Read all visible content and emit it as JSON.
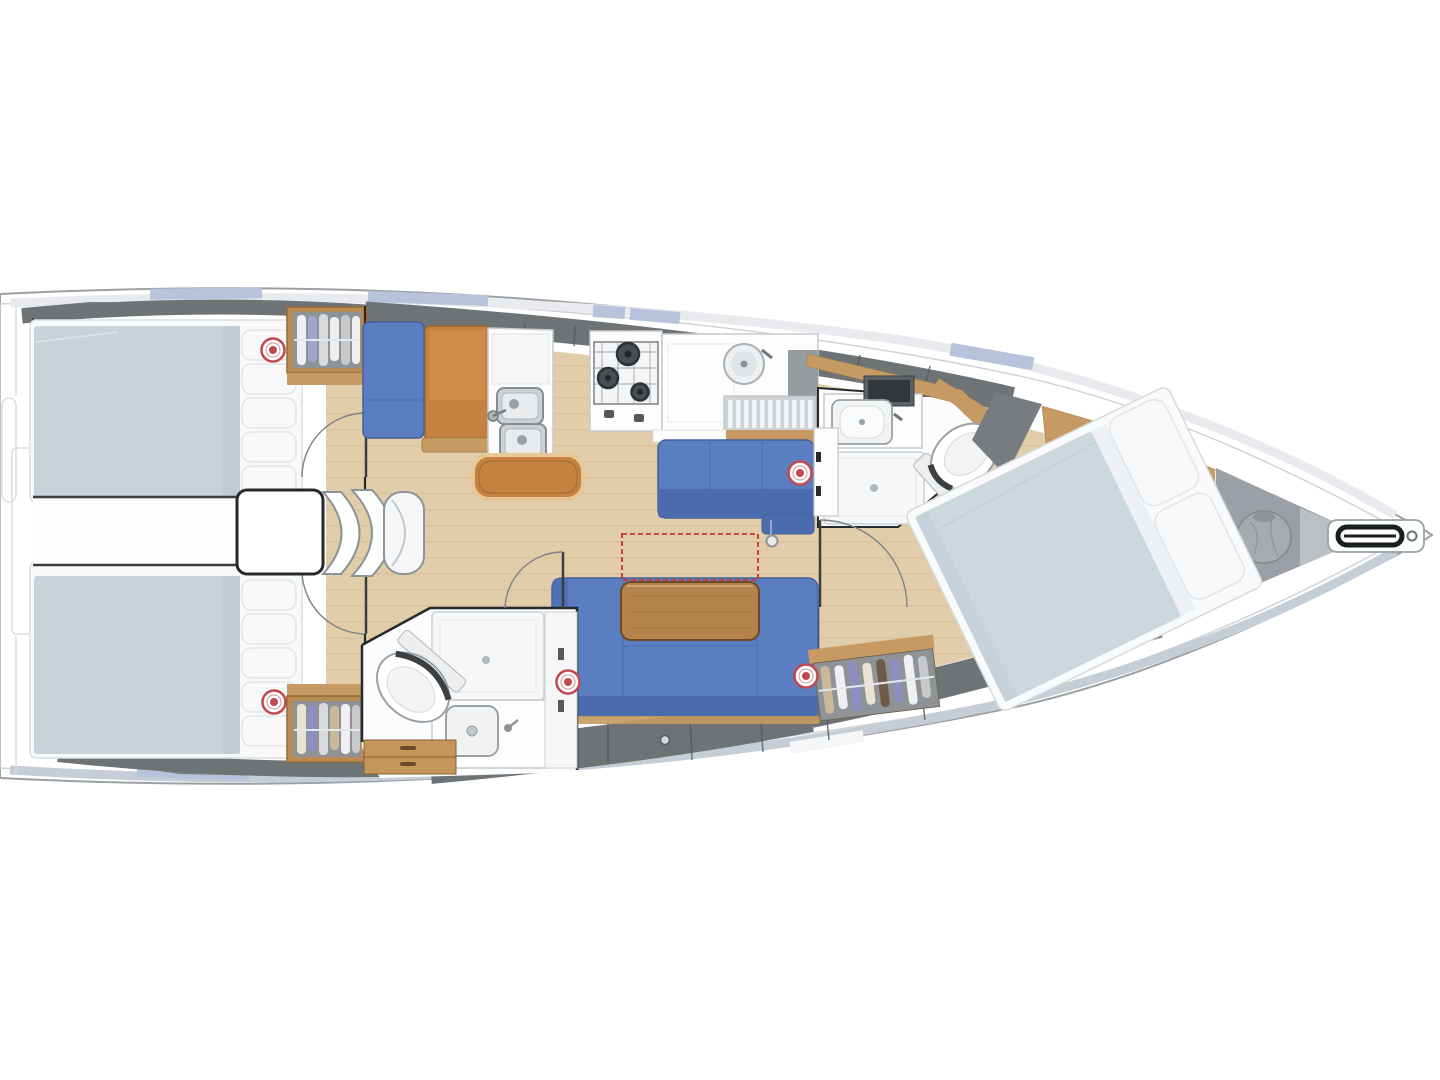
{
  "diagram": {
    "type": "sailboat-interior-floor-plan",
    "view": "top-down",
    "orientation": "bow-pointing-right",
    "rooms": [
      "aft-cabin-port",
      "aft-cabin-starboard",
      "companionway",
      "nav-station",
      "galley",
      "aft-head",
      "salon",
      "forward-head",
      "forward-cabin",
      "anchor-locker"
    ],
    "equipment": [
      "double-berth-aft-port",
      "double-berth-aft-starboard",
      "engine-box",
      "companionway-steps",
      "hanging-locker-aft-port",
      "hanging-locker-aft-starboard",
      "hanging-locker-forward",
      "nav-seat",
      "chart-table",
      "double-sink",
      "stove",
      "galley-counter",
      "round-sink",
      "dish-rack",
      "galley-bench",
      "port-settee",
      "dinette-settee",
      "salon-table",
      "table-extension-outline",
      "mast-foot",
      "toilet-aft",
      "shower-aft",
      "washbasin-aft",
      "toilet-forward",
      "shower-forward",
      "washbasin-forward",
      "forward-double-berth",
      "sail-bag",
      "bowsprit",
      "anchor-roller"
    ],
    "deck_hatch_count": 5
  },
  "colors": {
    "bg": "#ffffff",
    "hull_stroke": "#9aa0a4",
    "liner": "#cdd1d5",
    "deck_band": "#e8eaed",
    "deck_band_bottom": "#c5cdd7",
    "window_tint": "#b7c3da",
    "coachroof_gray": "#6e7376",
    "dark_wedge": "#777c80",
    "floor_wood": "#e2cdab",
    "floor_plank": "#c9ae86",
    "wood_trim": "#c69a62",
    "wood_furniture": "#c5813f",
    "table_wood": "#b5824c",
    "upholstery": "#5b7ec0",
    "upholstery_dark": "#4a6bad",
    "mattress": "#c9d2d9",
    "mattress_fwd": "#ccd7de",
    "linen_white": "#f7f8f9",
    "fixture_white": "#fdfdfe",
    "fixture_stroke": "#c6cacd",
    "locker_gray": "#8f9396",
    "anchor_locker_gray": "#9aa0a5",
    "sailbag_gray": "#a6abaf",
    "hatch_red": "#c0484f",
    "dashed_red": "#cc3434",
    "wall": "#26292c"
  }
}
